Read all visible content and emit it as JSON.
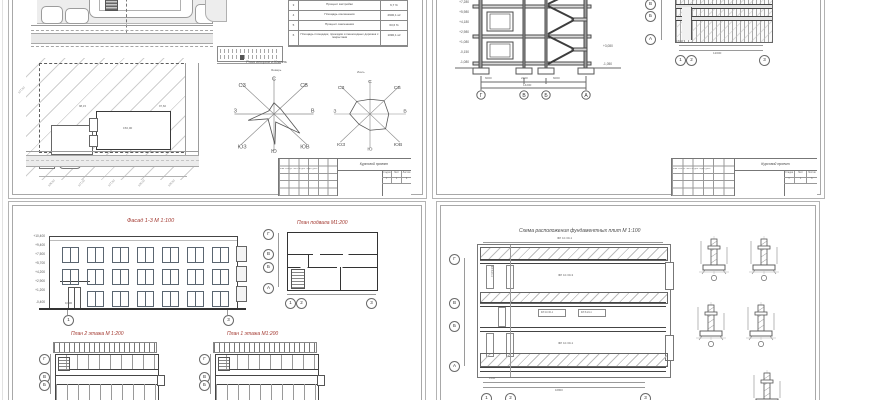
{
  "colors": {
    "title_red": "#a33a32",
    "line_dark": "#3c3c3c",
    "line_mid": "#6a6a6a",
    "hatch": "#bdbdbd",
    "road_fill": "#ebebeb"
  },
  "stamp": {
    "project": "Курсовой проект",
    "stage_label": "Стадия",
    "sheet_label": "Лист",
    "sheets_label": "Листов",
    "stage": "У",
    "sheet_no": "1",
    "sheets_total": "6",
    "cols": "Изм. Кол.уч. Лист № док. Подп. Дата"
  },
  "sheet1": {
    "tep_table": {
      "rows": [
        {
          "n": "1",
          "label": "Площадь участка",
          "value": "4557,0 м²"
        },
        {
          "n": "2",
          "label": "Площадь застройки",
          "value": "305,76 м²"
        },
        {
          "n": "3",
          "label": "Процент застройки",
          "value": "6,7 %"
        },
        {
          "n": "4",
          "label": "Площадь озеленения",
          "value": "2900,1 м²"
        },
        {
          "n": "5",
          "label": "Процент озеленения",
          "value": "63,6 %"
        },
        {
          "n": "6",
          "label": "Площадь площадок, проездов и пешеходных дорожек с покрытием",
          "value": "1090,1 м²"
        }
      ]
    },
    "wind_rose_title": "Роза ветров г.Казань",
    "rose_left_label": "Январь",
    "rose_right_label": "Июль",
    "compass": [
      "С",
      "СВ",
      "В",
      "ЮВ",
      "Ю",
      "ЮЗ",
      "З",
      "СЗ"
    ],
    "site": {
      "building_label": "150,00",
      "corner_mark_left": "98,15",
      "corner_mark_right": "97,60",
      "contour_labels": [
        "126,50",
        "127,00",
        "127,50",
        "128,00",
        "128,50"
      ]
    }
  },
  "sheet2": {
    "elev_left": [
      "+8,380",
      "+7,280",
      "+5,980",
      "+4,180",
      "+2,980",
      "+1,080",
      "-0,150",
      "-1,080"
    ],
    "elev_right": [
      "+3,080",
      "-1,050"
    ],
    "axes_section": [
      "Г",
      "В",
      "Б",
      "А"
    ],
    "dims_section": [
      "6000",
      "2200",
      "6000"
    ],
    "dim_total": "14200",
    "plan_axes_left": [
      "В",
      "Б",
      "А"
    ],
    "plan_axes_bottom": [
      "1",
      "2",
      "3"
    ],
    "plan_dim_first": "1500",
    "plan_dim_total": "12000"
  },
  "sheet3": {
    "title_facade": "Фасад 1-3 М 1:100",
    "title_basement": "План подвала М1:200",
    "title_floor2": "План 2 этажа М 1:200",
    "title_floor1": "План 1 этажа М1:200",
    "facade_marks": [
      "+10,400",
      "+9,400",
      "+7,500",
      "+5,700",
      "+4,200",
      "+2,900",
      "+1,200",
      "-0,400"
    ],
    "entry_mark": "0,000",
    "facade_axes": [
      "1",
      "3"
    ],
    "basement_axes_left": [
      "Г",
      "В",
      "Б",
      "А"
    ],
    "basement_axes_bottom": [
      "1",
      "2",
      "3"
    ],
    "floor_axes_left": [
      "Г",
      "В",
      "Б"
    ]
  },
  "sheet4": {
    "title": "Схема расположения фундаментных плит  М 1:100",
    "top_label": "ФЛ 10.30-1",
    "plate_labels": [
      "ФЛ 10.30-1",
      "ФЛ 10.30-3",
      "ФЛ 8.24-1"
    ],
    "axes_left": [
      "Г",
      "В",
      "Б",
      "А"
    ],
    "axes_bottom": [
      "1",
      "2",
      "3"
    ],
    "dim_first": "1500",
    "dim_total": "16800"
  }
}
